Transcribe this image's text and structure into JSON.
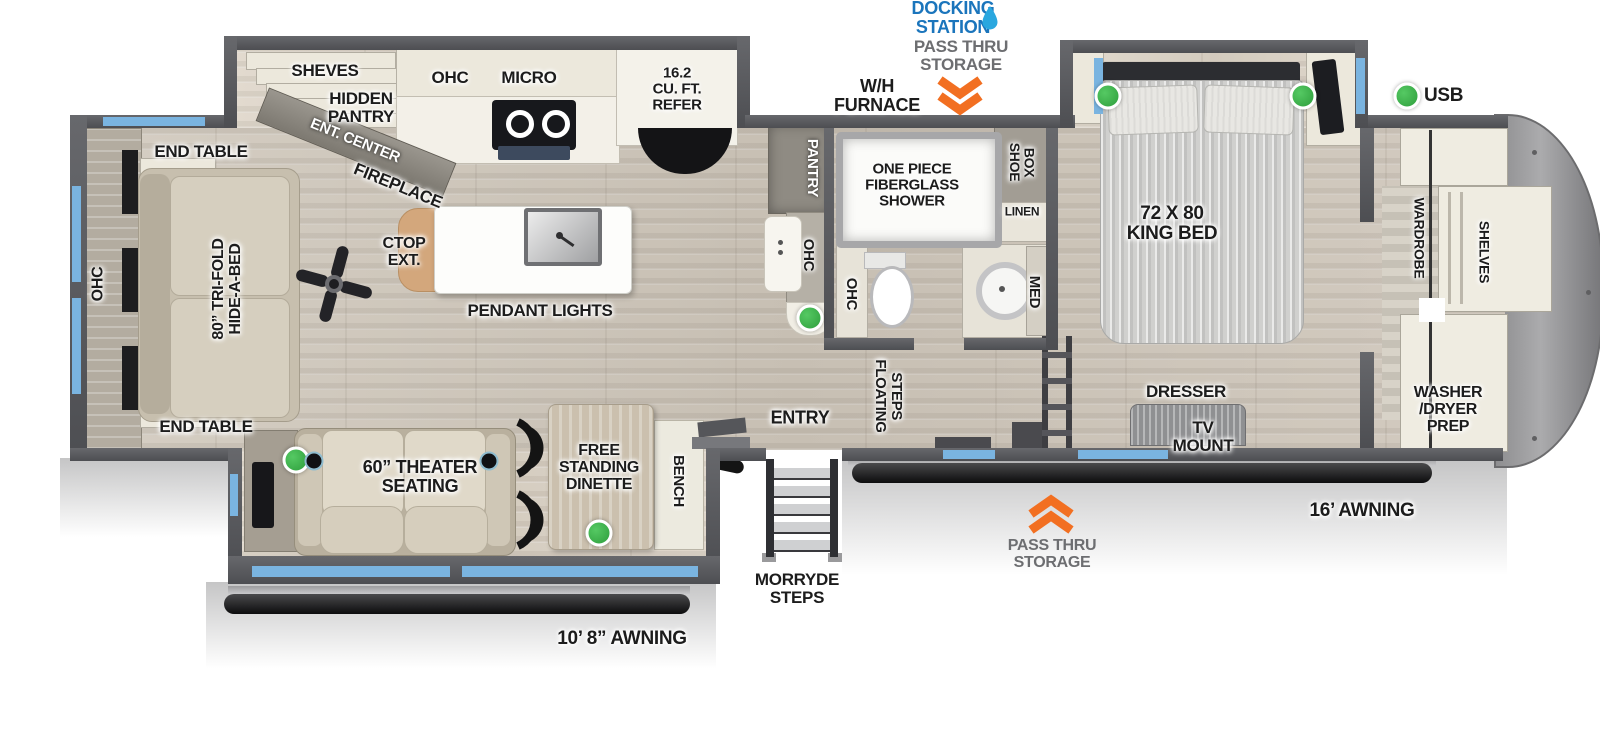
{
  "meta": {
    "title": "Fifth wheel RV floorplan"
  },
  "colors": {
    "accent_blue": "#1b75bc",
    "chevron_orange": "#f26f21",
    "led_green": "#3bb54a",
    "window_blue": "#7ab4e0",
    "wall_gray": "#58595b"
  },
  "labels": {
    "docking_station": "DOCKING\nSTATION",
    "pass_thru_top": "PASS THRU\nSTORAGE",
    "wh_furnace": "W/H\nFURNACE",
    "sheves": "SHEVES",
    "hidden_pantry": "HIDDEN\nPANTRY",
    "ent_center": "ENT. CENTER",
    "fireplace": "FIREPLACE",
    "ohc_kitchen": "OHC",
    "micro": "MICRO",
    "refer": "16.2\nCU. FT.\nREFER",
    "end_table_top": "END TABLE",
    "end_table_bottom": "END TABLE",
    "ohc_rear": "OHC",
    "hide_a_bed": "80” TRI-FOLD\nHIDE-A-BED",
    "ctop_ext": "CTOP\nEXT.",
    "pendant_lights": "PENDANT LIGHTS",
    "pantry": "PANTRY",
    "ohc_counter": "OHC",
    "shower": "ONE PIECE\nFIBERGLASS\nSHOWER",
    "shoe_box": "SHOE\nBOX",
    "linen": "LINEN",
    "ohc_bath": "OHC",
    "med": "MED",
    "floating_steps": "FLOATING\nSTEPS",
    "entry": "ENTRY",
    "morryde_steps": "MORRYDE\nSTEPS",
    "bench": "BENCH",
    "theater_seating": "60” THEATER\nSEATING",
    "dinette": "FREE\nSTANDING\nDINETTE",
    "king_bed": "72 X 80\nKING BED",
    "dresser": "DRESSER",
    "tv_mount": "TV\nMOUNT",
    "usb": "USB",
    "wardrobe": "WARDROBE",
    "shelves_front": "SHELVES",
    "washer_dryer": "WASHER\n/DRYER\nPREP",
    "awning_left": "10’ 8” AWNING",
    "awning_right": "16’ AWNING",
    "pass_thru_bottom": "PASS THRU\nSTORAGE"
  }
}
